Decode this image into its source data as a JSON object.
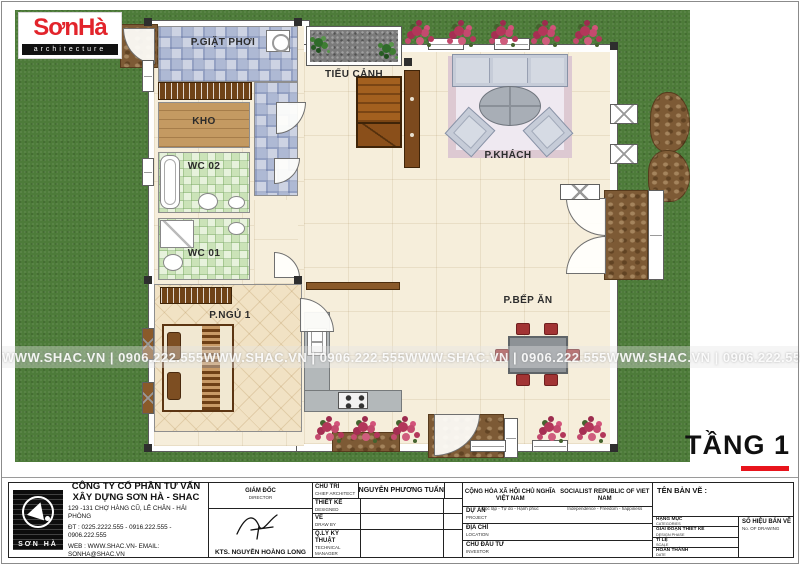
{
  "colors": {
    "brand_red": "#e2242b",
    "accent_bar_red": "#e8141c",
    "grass_green": "#4d7b39"
  },
  "logo": {
    "brand": "SơnHà",
    "subtitle": "architecture"
  },
  "floor_label": "TẦNG 1",
  "watermark": {
    "text": "WWW.SHAC.VN  |  0906.222.555"
  },
  "plan": {
    "labels": {
      "laundry": "P.GIẶT PHƠI",
      "garden": "TIỂU CẢNH",
      "storage": "KHO",
      "wc2": "WC 02",
      "wc1": "WC 01",
      "bedroom": "P.NGỦ 1",
      "living": "P.KHÁCH",
      "kitchen": "P.BẾP ĂN"
    }
  },
  "title_block": {
    "company": {
      "logo_text": "SƠN HÀ",
      "name_line1": "CÔNG TY CỔ PHẦN TƯ VẤN",
      "name_line2": "XÂY DỰNG SƠN HÀ - SHAC",
      "address": "129 -131  CHỢ HÀNG CŨ,  LÊ CHÂN - HẢI PHÒNG",
      "phone": "ĐT : 0225.2222.555 - 0916.222.555 - 0906.222.555",
      "web": "WEB : WWW.SHAC.VN- EMAIL: SONHA@SHAC.VN"
    },
    "director": {
      "label_vi": "GIÁM ĐỐC",
      "label_en": "DIRECTOR",
      "name": "KTS. NGUYỄN HOÀNG LONG"
    },
    "staff_rows": [
      {
        "label_vi": "CHỦ TRÌ",
        "label_en": "CHIEF ARCHITECT",
        "value": "NGUYỄN PHƯƠNG TUẤN"
      },
      {
        "label_vi": "THIẾT KẾ",
        "label_en": "DESIGNED",
        "value": ""
      },
      {
        "label_vi": "VẼ",
        "label_en": "DRAW BY",
        "value": ""
      },
      {
        "label_vi": "Q.LÝ KỸ THUẬT",
        "label_en": "TECHNICAL MANAGER",
        "value": ""
      }
    ],
    "republic": {
      "vi_line1": "CỘNG HÒA XÃ HỘI CHỦ NGHĨA VIỆT NAM",
      "vi_line2": "Độc lập - Tự do - Hạnh phúc",
      "en_line1": "SOCIALIST REPUBLIC OF VIET NAM",
      "en_line2": "Independence - Freedom - happiness"
    },
    "project_rows": [
      {
        "label_vi": "DỰ ÁN",
        "label_en": "PROJECT"
      },
      {
        "label_vi": "ĐỊA CHỈ",
        "label_en": "LOCATION"
      },
      {
        "label_vi": "CHỦ ĐẦU TƯ",
        "label_en": "INVESTOR"
      }
    ],
    "drawing": {
      "title_label": "TÊN BẢN VẼ :",
      "rows": [
        {
          "label_vi": "HẠNG MỤC",
          "label_en": "CATEGORIES"
        },
        {
          "label_vi": "GIAI ĐOẠN THIẾT KẾ",
          "label_en": "DESIGN PHASE"
        },
        {
          "label_vi": "TỈ LỆ",
          "label_en": "SCALE"
        },
        {
          "label_vi": "HOÀN THÀNH",
          "label_en": "DATE"
        }
      ],
      "number_label_vi": "SỐ HIỆU BẢN VẼ",
      "number_label_en": "No. OF DRAWING"
    }
  }
}
